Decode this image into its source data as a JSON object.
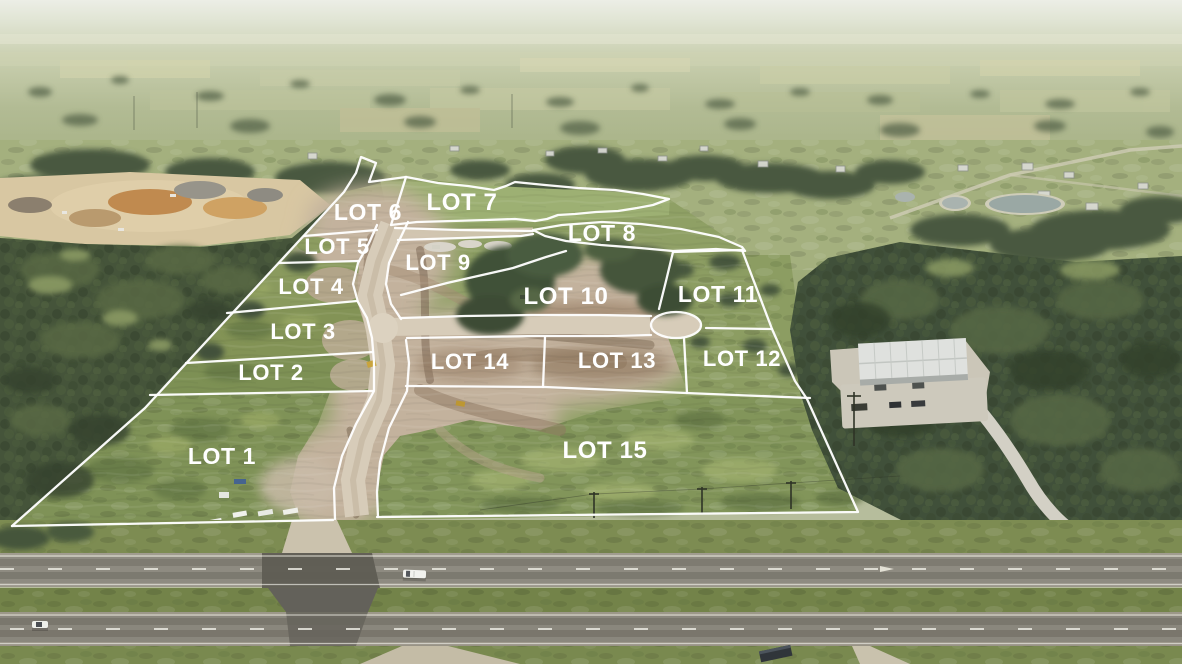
{
  "image": {
    "kind": "aerial-drone-photo-with-lot-overlay",
    "lot_count": 15
  },
  "overlay": {
    "line_color": "#ffffff",
    "label_color": "#ffffff",
    "lots": [
      {
        "id": "lot-1",
        "label": "LOT 1",
        "x": 222,
        "y": 464,
        "size": 23
      },
      {
        "id": "lot-2",
        "label": "LOT 2",
        "x": 271,
        "y": 380,
        "size": 22
      },
      {
        "id": "lot-3",
        "label": "LOT 3",
        "x": 303,
        "y": 339,
        "size": 22
      },
      {
        "id": "lot-4",
        "label": "LOT 4",
        "x": 311,
        "y": 294,
        "size": 22
      },
      {
        "id": "lot-5",
        "label": "LOT 5",
        "x": 337,
        "y": 254,
        "size": 22
      },
      {
        "id": "lot-6",
        "label": "LOT 6",
        "x": 368,
        "y": 220,
        "size": 23
      },
      {
        "id": "lot-7",
        "label": "LOT 7",
        "x": 462,
        "y": 210,
        "size": 24
      },
      {
        "id": "lot-8",
        "label": "LOT 8",
        "x": 602,
        "y": 241,
        "size": 23
      },
      {
        "id": "lot-9",
        "label": "LOT 9",
        "x": 438,
        "y": 270,
        "size": 22
      },
      {
        "id": "lot-10",
        "label": "LOT 10",
        "x": 566,
        "y": 304,
        "size": 24
      },
      {
        "id": "lot-11",
        "label": "LOT 11",
        "x": 718,
        "y": 302,
        "size": 23
      },
      {
        "id": "lot-12",
        "label": "LOT 12",
        "x": 742,
        "y": 366,
        "size": 22
      },
      {
        "id": "lot-13",
        "label": "LOT 13",
        "x": 617,
        "y": 368,
        "size": 22
      },
      {
        "id": "lot-14",
        "label": "LOT 14",
        "x": 470,
        "y": 369,
        "size": 22
      },
      {
        "id": "lot-15",
        "label": "LOT 15",
        "x": 605,
        "y": 458,
        "size": 24
      }
    ]
  },
  "scene": {
    "colors": {
      "haze": "#e9ece2",
      "distant_field": "#b9c09d",
      "forest": "#44533a",
      "pasture": "#93a46c",
      "dirt": "#c3b29d",
      "dirt_dark": "#8a7560",
      "grass": "#81945a",
      "asphalt": "#8b887e",
      "median_grass": "#75854c",
      "concrete": "#d8d5cc",
      "quarry_sand": "#d8c7a2",
      "quarry_orange": "#c4904f",
      "pond": "#a9b3af"
    },
    "features": [
      "sand-quarry",
      "stock-ponds",
      "metal-warehouse",
      "divided-highway",
      "median-crossover",
      "cul-de-sac",
      "construction-roads",
      "parked-vehicles",
      "construction-equipment"
    ]
  }
}
